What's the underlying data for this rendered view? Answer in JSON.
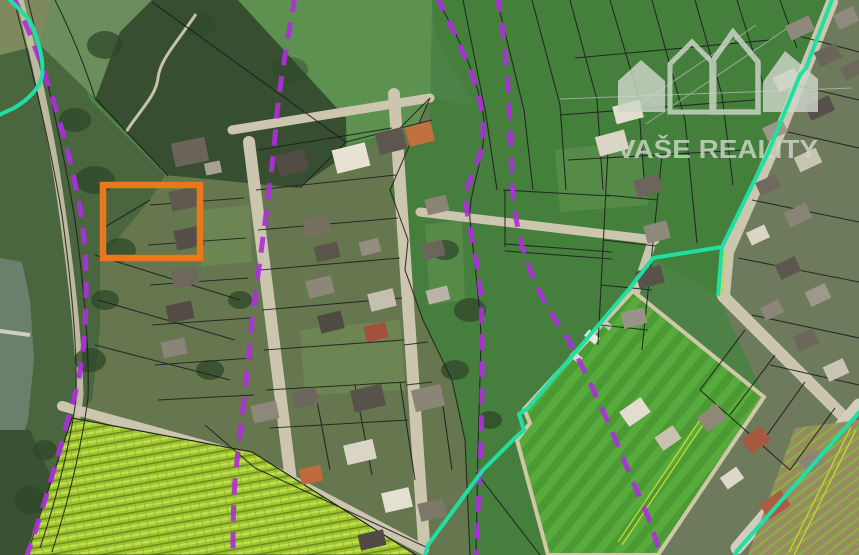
{
  "brand": {
    "name": "VAŠE REALITY",
    "icon": "houses-roofline-icon",
    "color": "#ced6ca"
  },
  "map_legend": {
    "selected_parcel_color": "#e8791b",
    "cadastral_boundary_dashed_color": "#ae2fdc",
    "cadastral_boundary_solid_color": "#21dfa2",
    "parcel_line_color": "#1d1d1d",
    "field_path_marking_color": "#c6d92f"
  }
}
